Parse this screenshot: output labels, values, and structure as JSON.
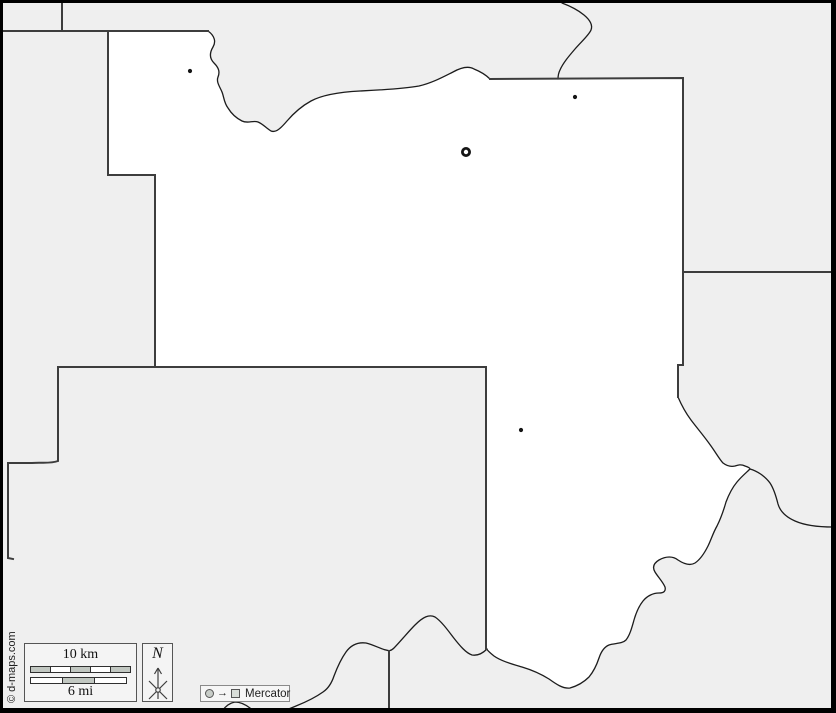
{
  "map": {
    "background_color": "#efefef",
    "county_fill": "#ffffff",
    "admin_line_color": "#3d3d3d",
    "river_line_color": "#1c1c1c",
    "frame_color": "#000000",
    "markers": {
      "county_seat": {
        "x": 466,
        "y": 152
      },
      "towns": [
        {
          "x": 190,
          "y": 71
        },
        {
          "x": 575,
          "y": 97
        },
        {
          "x": 521,
          "y": 430
        }
      ]
    }
  },
  "scale_bar": {
    "km_label": "10 km",
    "mi_label": "6 mi",
    "km_segments": 5,
    "mi_segments": 3,
    "segment_fill": "#c1c7c1",
    "segment_alt_fill": "#ffffff"
  },
  "compass": {
    "north_label": "N"
  },
  "projection_badge": {
    "label": "Mercator"
  },
  "copyright_text": "© d-maps.com"
}
